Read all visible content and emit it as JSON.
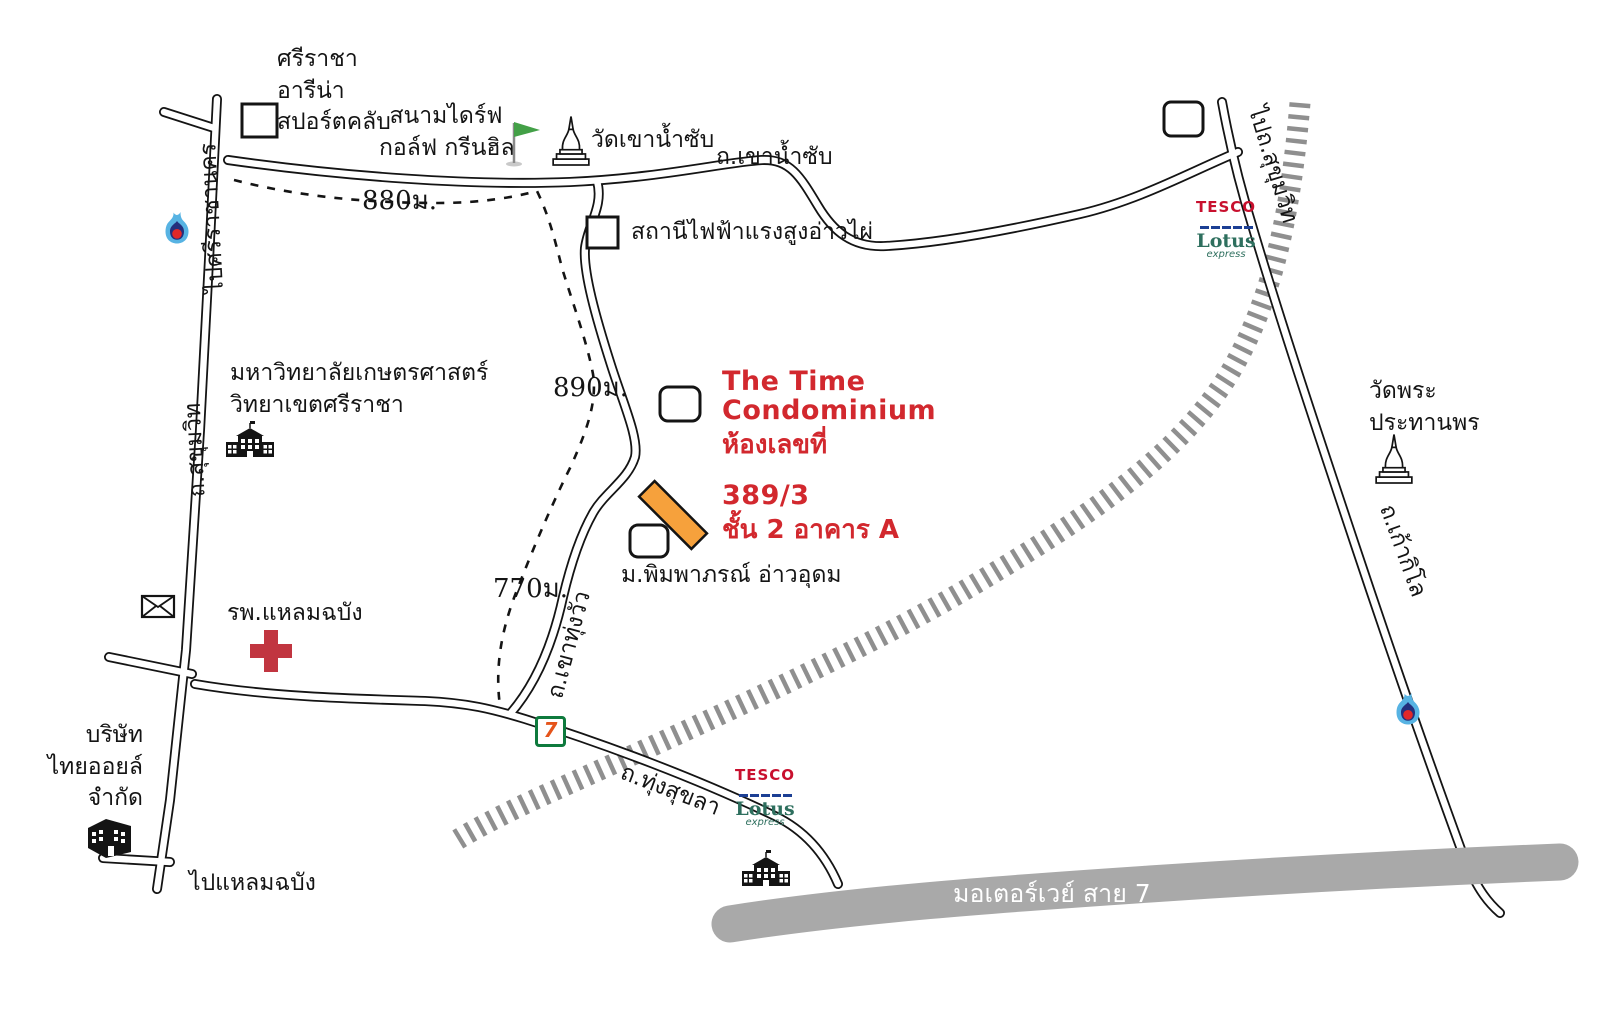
{
  "landmarks": {
    "sriracha_arena": {
      "line1": "ศรีราชา",
      "line2": "อารีน่า",
      "line3": "สปอร์ตคลับ"
    },
    "golf": {
      "line1": "สนามไดร์ฟ",
      "line2": "กอล์ฟ กรีนฮิล"
    },
    "wat_khao_namsap": "วัดเขาน้ำซับ",
    "power_station": "สถานีไฟฟ้าแรงสูงอ่าวไผ่",
    "kasetsart": {
      "line1": "มหาวิทยาลัยเกษตรศาสตร์",
      "line2": "วิทยาเขตศรีราชา"
    },
    "pimpaporn": "ม.พิมพาภรณ์ อ่าวอุดม",
    "hospital": "รพ.แหลมฉบัง",
    "thaioil": {
      "line1": "บริษัท",
      "line2": "ไทยออยล์",
      "line3": "จำกัด"
    },
    "wat_phra": {
      "line1": "วัดพระ",
      "line2": "ประทานพร"
    }
  },
  "destination": {
    "line1": "The Time",
    "line2": "Condominium",
    "line3": "ห้องเลขที่",
    "line4": "389/3",
    "line5": "ชั้น 2 อาคาร A",
    "text_color": "#d2282e",
    "building_color": "#f6a13c"
  },
  "roads": {
    "khao_namsap": "ถ.เขาน้ำซับ",
    "to_sriracha": "ไปศรีราชานคร",
    "sukhumvit": "ถ.สุขุมวิท",
    "to_sukhumvit": "ไปถ.สุขุมวิท",
    "khao_thung_wua": "ถ.เขาทุ่งวัว",
    "thung_sukhla": "ถ.ทุ่งสุขลา",
    "kao_kilo": "ถ.เก้ากิโล",
    "to_laem_chabang": "ไปแหลมฉบัง",
    "motorway": "มอเตอร์เวย์ สาย 7"
  },
  "distances": {
    "d880": "880ม.",
    "d890": "890ม.",
    "d770": "770ม."
  },
  "logos": {
    "tesco": {
      "line1": "TESCO",
      "line2": "Lotus",
      "line3": "express"
    },
    "seven": "7"
  },
  "icons": [
    "golf-flag-icon",
    "temple-stupa-icon",
    "fuel-station-icon",
    "building-marker",
    "university-building-icon",
    "post-office-icon",
    "hospital-cross-icon",
    "thaioil-building-icon",
    "school-building-icon",
    "railway-track",
    "motorway-band"
  ],
  "colors": {
    "road_outline": "#141414",
    "motorway_gray": "#a9a9a9",
    "railway_gray": "#8f8f8f",
    "cross_red": "#c13540",
    "flag_green": "#43a047",
    "ptt_blue": "#57b3e3",
    "ptt_navy": "#232f7d",
    "ptt_red": "#e12828",
    "tesco_red": "#c8102e",
    "tesco_blue": "#1c3f94",
    "lotus_green": "#2e6f5e",
    "seven_green": "#0e7a3d",
    "seven_orange": "#e5541b"
  }
}
